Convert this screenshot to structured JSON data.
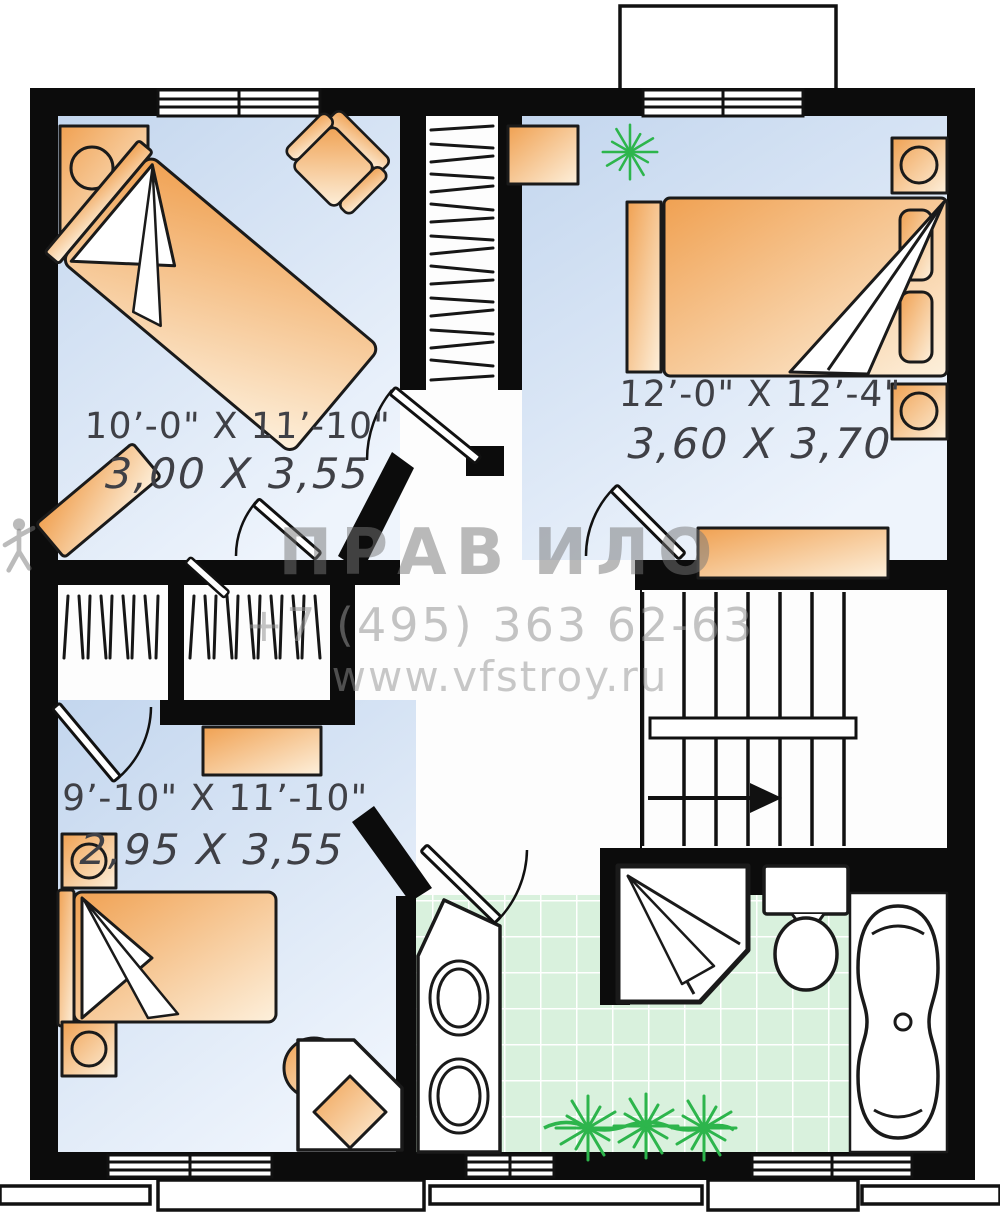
{
  "watermark": {
    "brand_left": "ПРАВ",
    "brand_right": "ИЛО",
    "phone": "+7 (495) 363 62-63",
    "website": "www.vfstroy.ru"
  },
  "rooms": [
    {
      "id": "bedroom-top-left",
      "size_imperial": "10’-0\" X 11’-10\"",
      "size_metric": "3,00 X 3,55"
    },
    {
      "id": "bedroom-top-right",
      "size_imperial": "12’-0\" X 12’-4\"",
      "size_metric": "3,60 X 3,70"
    },
    {
      "id": "bedroom-bottom-left",
      "size_imperial": "9’-10\" X 11’-10\"",
      "size_metric": "2,95 X 3,55"
    }
  ],
  "fixtures": [
    "single-bed-diagonal",
    "double-bed",
    "single-bed",
    "armchair",
    "nightstand-with-lamp",
    "dresser",
    "hatched-wardrobe-closet",
    "staircase-with-direction-arrow",
    "corner-shower",
    "toilet",
    "bathtub",
    "vanity-with-two-sinks",
    "desk-with-chair",
    "green-plant"
  ],
  "colors": {
    "wall": "#0c0c0c",
    "floor_blue": "#c3d6ee",
    "furniture_orange": "#f0a152",
    "tile_green": "#d9f1dd",
    "plant_green": "#2db54c",
    "watermark_gray": "#8a8a8a",
    "dimension_text": "#3f4046"
  }
}
